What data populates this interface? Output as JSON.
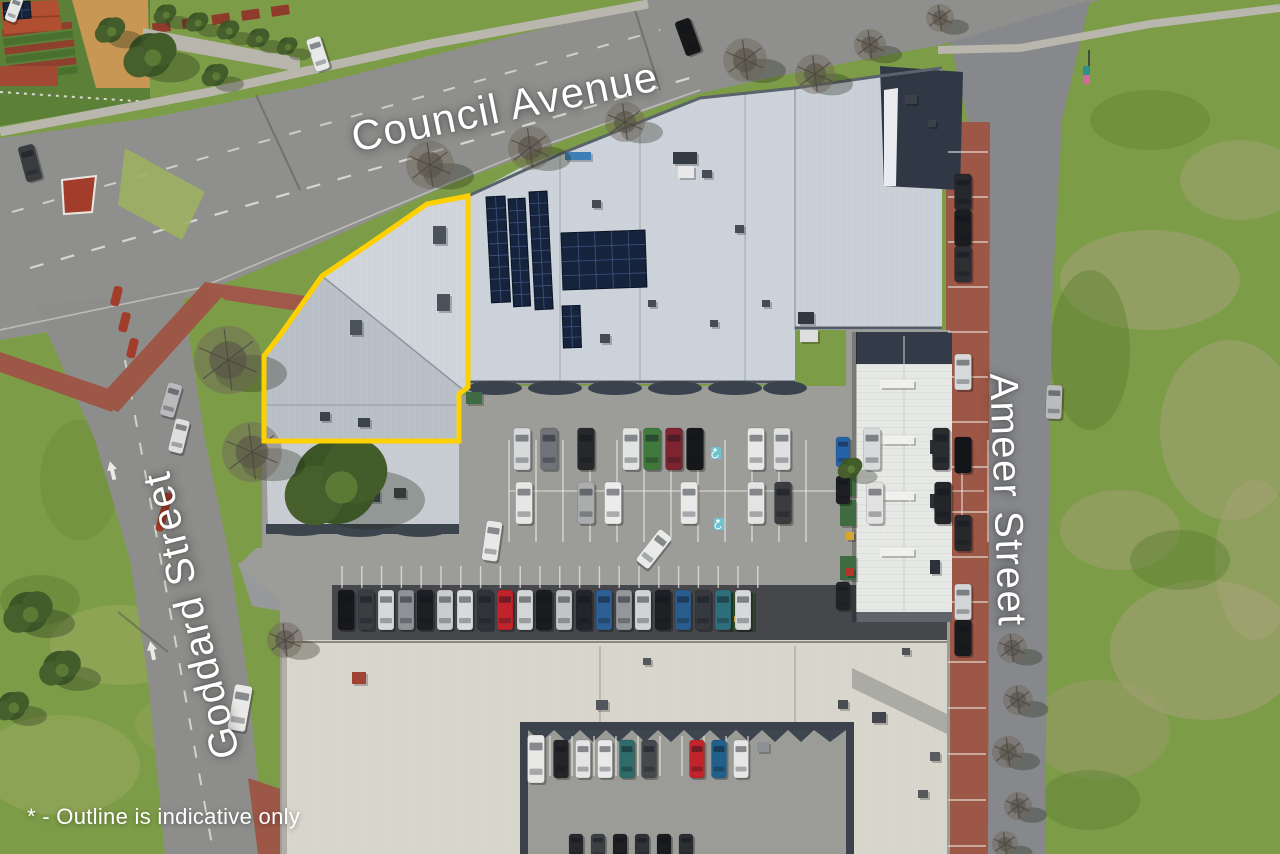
{
  "overlay": {
    "street_labels": [
      {
        "id": "council-avenue",
        "text": "Council Avenue",
        "x": 505,
        "y": 107,
        "rotation": -11.5,
        "font_size": 42
      },
      {
        "id": "goddard-street",
        "text": "Goddard Street",
        "x": 192,
        "y": 615,
        "rotation": -104,
        "font_size": 40
      },
      {
        "id": "ameer-street",
        "text": "Ameer Street",
        "x": 1007,
        "y": 500,
        "rotation": 88,
        "font_size": 40
      }
    ],
    "disclaimer": {
      "text": "* - Outline is indicative only",
      "x": 27,
      "y": 804,
      "font_size": 22
    },
    "text_color": "#ffffff"
  },
  "property_outline": {
    "color": "#fdd000",
    "stroke_width": 5,
    "points": "468,196 427,204 381,236 322,276 281,334 264,356 264,441 459,441 459,394 468,387"
  },
  "palette": {
    "grass": "#7d9c48",
    "grass_dark": "#5d8038",
    "road": "#8f908d",
    "asphalt": "#9c9c98",
    "roof_main": "#ccd2d9",
    "roof_outlined_light": "#cfd4db",
    "roof_outlined_dark": "#b9bfc7",
    "roof_bottom": "#d8d5ca",
    "roof_wing": "#e6e8e6",
    "roof_dark": "#2f3844",
    "brick": "#9d5747",
    "concrete": "#b8b6ad",
    "solar": "#16233c",
    "tree_leafy": "#3c5527",
    "tree_bare": "#6f675c"
  },
  "scene": {
    "cars": [
      [
        346,
        610,
        40,
        16,
        0,
        "#17181b"
      ],
      [
        366,
        610,
        40,
        16,
        0,
        "#3a3d42"
      ],
      [
        386,
        610,
        40,
        16,
        0,
        "#d6d8da"
      ],
      [
        406,
        610,
        40,
        16,
        0,
        "#8f9296"
      ],
      [
        425,
        610,
        40,
        16,
        0,
        "#1d1f23"
      ],
      [
        445,
        610,
        40,
        16,
        0,
        "#caccce"
      ],
      [
        465,
        610,
        40,
        16,
        0,
        "#d9dadb"
      ],
      [
        485,
        610,
        40,
        16,
        0,
        "#303339"
      ],
      [
        505,
        610,
        40,
        16,
        0,
        "#c1232b"
      ],
      [
        525,
        610,
        40,
        16,
        0,
        "#d5d6d8"
      ],
      [
        544,
        610,
        40,
        16,
        0,
        "#1a1c1f"
      ],
      [
        564,
        610,
        40,
        16,
        0,
        "#c2c4c6"
      ],
      [
        584,
        610,
        40,
        16,
        0,
        "#23252a"
      ],
      [
        604,
        610,
        40,
        16,
        0,
        "#2e5f93"
      ],
      [
        624,
        610,
        40,
        16,
        0,
        "#93969a"
      ],
      [
        643,
        610,
        40,
        16,
        0,
        "#d2d3d5"
      ],
      [
        663,
        610,
        40,
        16,
        0,
        "#1e2024"
      ],
      [
        683,
        610,
        40,
        16,
        0,
        "#2b5c8e"
      ],
      [
        703,
        610,
        40,
        16,
        0,
        "#36393e"
      ],
      [
        723,
        610,
        40,
        16,
        0,
        "#2e6f7c"
      ],
      [
        743,
        610,
        40,
        16,
        0,
        "#d7d8d9"
      ],
      [
        522,
        449,
        42,
        17,
        0,
        "#d8d9da"
      ],
      [
        549,
        449,
        42,
        17,
        0,
        "#70747a"
      ],
      [
        586,
        449,
        42,
        17,
        0,
        "#26282c"
      ],
      [
        631,
        449,
        42,
        17,
        0,
        "#e2e3e3"
      ],
      [
        652,
        449,
        42,
        17,
        0,
        "#3f7a3c"
      ],
      [
        674,
        449,
        42,
        17,
        0,
        "#7e2430"
      ],
      [
        695,
        449,
        42,
        17,
        0,
        "#17181b"
      ],
      [
        756,
        449,
        42,
        17,
        0,
        "#e8e8e8"
      ],
      [
        782,
        449,
        42,
        17,
        0,
        "#dfe0e1"
      ],
      [
        872,
        449,
        42,
        17,
        0,
        "#d9dadb"
      ],
      [
        941,
        449,
        42,
        17,
        0,
        "#2a2c2f"
      ],
      [
        524,
        503,
        42,
        17,
        0,
        "#e6e6e6"
      ],
      [
        586,
        503,
        42,
        17,
        0,
        "#aaacae"
      ],
      [
        613,
        503,
        42,
        17,
        0,
        "#ececec"
      ],
      [
        689,
        503,
        42,
        17,
        0,
        "#e8e9e9"
      ],
      [
        756,
        503,
        42,
        17,
        0,
        "#e4e4e4"
      ],
      [
        783,
        503,
        42,
        17,
        0,
        "#3a3c40"
      ],
      [
        875,
        503,
        42,
        17,
        0,
        "#e2e2e2"
      ],
      [
        943,
        503,
        42,
        17,
        0,
        "#232529"
      ],
      [
        654,
        549,
        40,
        16,
        38,
        "#e9eaea"
      ],
      [
        492,
        541,
        40,
        16,
        8,
        "#e7e8e8"
      ],
      [
        536,
        759,
        48,
        17,
        0,
        "#e8e8e6"
      ],
      [
        561,
        759,
        38,
        15,
        0,
        "#232528"
      ],
      [
        583,
        759,
        38,
        15,
        0,
        "#e4e4e4"
      ],
      [
        605,
        759,
        38,
        15,
        0,
        "#e9e9e9"
      ],
      [
        627,
        759,
        38,
        15,
        0,
        "#2e6b6b"
      ],
      [
        649,
        759,
        38,
        15,
        0,
        "#45484c"
      ],
      [
        697,
        759,
        38,
        15,
        0,
        "#c1252b"
      ],
      [
        719,
        759,
        38,
        15,
        0,
        "#20608c"
      ],
      [
        741,
        759,
        38,
        15,
        0,
        "#e6e6e6"
      ],
      [
        576,
        847,
        26,
        14,
        0,
        "#26282c"
      ],
      [
        598,
        847,
        26,
        14,
        0,
        "#3c3f44"
      ],
      [
        620,
        847,
        26,
        14,
        0,
        "#1d1f22"
      ],
      [
        642,
        847,
        26,
        14,
        0,
        "#2f3237"
      ],
      [
        664,
        847,
        26,
        14,
        0,
        "#191b1e"
      ],
      [
        686,
        847,
        26,
        14,
        0,
        "#2b2e33"
      ],
      [
        963,
        192,
        36,
        17,
        0,
        "#26282b"
      ],
      [
        963,
        228,
        36,
        17,
        0,
        "#1b1d20"
      ],
      [
        963,
        264,
        36,
        17,
        0,
        "#2d2f33"
      ],
      [
        963,
        372,
        36,
        17,
        0,
        "#d8d9da"
      ],
      [
        963,
        455,
        36,
        17,
        0,
        "#141518"
      ],
      [
        963,
        533,
        36,
        17,
        0,
        "#28292c"
      ],
      [
        963,
        602,
        36,
        17,
        0,
        "#d4d5d6"
      ],
      [
        963,
        638,
        36,
        17,
        0,
        "#1a1b1e"
      ],
      [
        1054,
        402,
        34,
        16,
        2,
        "#b9bbbd"
      ],
      [
        171,
        400,
        34,
        15,
        16,
        "#b9babc"
      ],
      [
        179,
        436,
        34,
        15,
        14,
        "#dedfdf"
      ],
      [
        240,
        708,
        46,
        18,
        10,
        "#e9e9e7"
      ],
      [
        318,
        54,
        34,
        15,
        -18,
        "#e8e9e9"
      ],
      [
        30,
        163,
        36,
        16,
        -15,
        "#3a3d40"
      ],
      [
        688,
        37,
        36,
        16,
        -20,
        "#17181a"
      ],
      [
        14,
        9,
        26,
        12,
        20,
        "#e5e6e6"
      ],
      [
        843,
        452,
        30,
        14,
        0,
        "#2563a8"
      ],
      [
        843,
        490,
        28,
        14,
        0,
        "#1d1f22"
      ],
      [
        843,
        596,
        28,
        14,
        0,
        "#222428"
      ]
    ],
    "trees": [
      [
        336,
        482,
        54,
        "leafy"
      ],
      [
        850,
        468,
        13,
        "leafy"
      ],
      [
        28,
        612,
        26,
        "leafy"
      ],
      [
        60,
        668,
        22,
        "leafy"
      ],
      [
        12,
        706,
        18,
        "leafy"
      ],
      [
        150,
        55,
        28,
        "leafy"
      ],
      [
        165,
        14,
        12,
        "leafy"
      ],
      [
        197,
        22,
        12,
        "leafy"
      ],
      [
        228,
        30,
        12,
        "leafy"
      ],
      [
        258,
        38,
        12,
        "leafy"
      ],
      [
        287,
        46,
        11,
        "leafy"
      ],
      [
        110,
        30,
        16,
        "leafy"
      ],
      [
        215,
        75,
        14,
        "leafy"
      ],
      [
        228,
        360,
        34,
        "bare"
      ],
      [
        252,
        452,
        30,
        "bare"
      ],
      [
        430,
        165,
        24,
        "bare"
      ],
      [
        530,
        148,
        22,
        "bare"
      ],
      [
        625,
        122,
        20,
        "bare"
      ],
      [
        745,
        60,
        22,
        "bare"
      ],
      [
        815,
        74,
        20,
        "bare"
      ],
      [
        870,
        45,
        16,
        "bare"
      ],
      [
        1012,
        648,
        15,
        "bare"
      ],
      [
        1018,
        700,
        15,
        "bare"
      ],
      [
        1008,
        752,
        16,
        "bare"
      ],
      [
        1018,
        806,
        14,
        "bare"
      ],
      [
        1005,
        844,
        13,
        "bare"
      ],
      [
        285,
        640,
        18,
        "bare"
      ],
      [
        940,
        18,
        14,
        "bare"
      ]
    ],
    "solar_arrays": [
      {
        "x": 486,
        "y": 197,
        "w": 19,
        "h": 106,
        "cols": 2,
        "rows": 9,
        "rot": -3
      },
      {
        "x": 508,
        "y": 199,
        "w": 17,
        "h": 108,
        "cols": 2,
        "rows": 9,
        "rot": -3
      },
      {
        "x": 529,
        "y": 192,
        "w": 18,
        "h": 118,
        "cols": 2,
        "rows": 10,
        "rot": -3
      },
      {
        "x": 561,
        "y": 233,
        "w": 84,
        "h": 57,
        "cols": 5,
        "rows": 4,
        "rot": -2
      },
      {
        "x": 562,
        "y": 306,
        "w": 18,
        "h": 42,
        "cols": 2,
        "rows": 4,
        "rot": -2
      },
      {
        "x": 3,
        "y": 3,
        "w": 27,
        "h": 17,
        "cols": 3,
        "rows": 2,
        "rot": -4
      }
    ],
    "roof_units": [
      [
        433,
        226,
        13,
        18,
        "#4a525c"
      ],
      [
        437,
        294,
        13,
        17,
        "#4a525c"
      ],
      [
        350,
        320,
        12,
        15,
        "#4a525c"
      ],
      [
        320,
        412,
        10,
        9,
        "#3a424c"
      ],
      [
        358,
        418,
        12,
        9,
        "#3a424c"
      ],
      [
        342,
        485,
        16,
        14,
        "#c2a576"
      ],
      [
        366,
        490,
        14,
        12,
        "#3a424c"
      ],
      [
        394,
        488,
        12,
        10,
        "#3a424c"
      ],
      [
        600,
        334,
        10,
        9,
        "#454c54"
      ],
      [
        648,
        300,
        8,
        7,
        "#454c54"
      ],
      [
        673,
        152,
        24,
        12,
        "#343b42"
      ],
      [
        678,
        166,
        16,
        12,
        "#e8e8e8"
      ],
      [
        702,
        170,
        10,
        8,
        "#454c54"
      ],
      [
        735,
        225,
        9,
        8,
        "#454c54"
      ],
      [
        762,
        300,
        8,
        7,
        "#454c54"
      ],
      [
        710,
        320,
        8,
        7,
        "#454c54"
      ],
      [
        592,
        200,
        9,
        8,
        "#454c54"
      ],
      [
        565,
        152,
        26,
        8,
        "#3f7fb5"
      ],
      [
        798,
        312,
        16,
        12,
        "#31383f"
      ],
      [
        800,
        330,
        18,
        12,
        "#dcdddc"
      ],
      [
        905,
        95,
        12,
        9,
        "#3a4148"
      ],
      [
        928,
        120,
        8,
        7,
        "#3a4148"
      ],
      [
        466,
        392,
        16,
        12,
        "#3f6b42"
      ],
      [
        840,
        470,
        16,
        26,
        "#3e6b40"
      ],
      [
        840,
        500,
        16,
        26,
        "#3e6b40"
      ],
      [
        840,
        556,
        16,
        24,
        "#3e6b40"
      ],
      [
        846,
        532,
        8,
        8,
        "#d9a62a"
      ],
      [
        846,
        568,
        8,
        8,
        "#b5342c"
      ],
      [
        728,
        592,
        26,
        38,
        "#2f4a2c"
      ],
      [
        734,
        616,
        10,
        6,
        "#c8a23a"
      ],
      [
        352,
        672,
        14,
        12,
        "#a14334"
      ],
      [
        596,
        700,
        12,
        10,
        "#53565a"
      ],
      [
        757,
        742,
        12,
        10,
        "#8d9094"
      ],
      [
        643,
        658,
        8,
        7,
        "#55585c"
      ],
      [
        872,
        712,
        14,
        11,
        "#42464c"
      ],
      [
        930,
        752,
        10,
        9,
        "#595c60"
      ],
      [
        902,
        648,
        8,
        7,
        "#505356"
      ],
      [
        838,
        700,
        10,
        9,
        "#4a4d52"
      ],
      [
        918,
        790,
        10,
        8,
        "#54575b"
      ],
      [
        880,
        380,
        34,
        8,
        "#f0f1ef"
      ],
      [
        880,
        436,
        34,
        8,
        "#f0f1ef"
      ],
      [
        880,
        492,
        34,
        8,
        "#f0f1ef"
      ],
      [
        880,
        548,
        34,
        8,
        "#f0f1ef"
      ],
      [
        930,
        440,
        10,
        14,
        "#2b3138"
      ],
      [
        930,
        494,
        10,
        14,
        "#2b3138"
      ],
      [
        930,
        560,
        10,
        14,
        "#2b3138"
      ]
    ],
    "bay_rows": [
      {
        "o": "v",
        "x": 509,
        "y": 440,
        "n": 12,
        "p": 27,
        "len": 102
      },
      {
        "o": "v",
        "x": 858,
        "y": 440,
        "n": 6,
        "p": 26,
        "len": 102
      },
      {
        "o": "v",
        "x": 342,
        "y": 566,
        "n": 22,
        "p": 19.8,
        "len": 22
      },
      {
        "o": "v",
        "x": 550,
        "y": 736,
        "n": 10,
        "p": 22,
        "len": 40
      },
      {
        "o": "h",
        "x": 948,
        "y": 152,
        "n": 11,
        "p": 45,
        "len": 40
      },
      {
        "o": "h",
        "x": 948,
        "y": 662,
        "n": 5,
        "p": 46,
        "len": 38
      }
    ],
    "handicap_bays": [
      {
        "x": 716,
        "y": 453
      },
      {
        "x": 719,
        "y": 524
      }
    ]
  }
}
